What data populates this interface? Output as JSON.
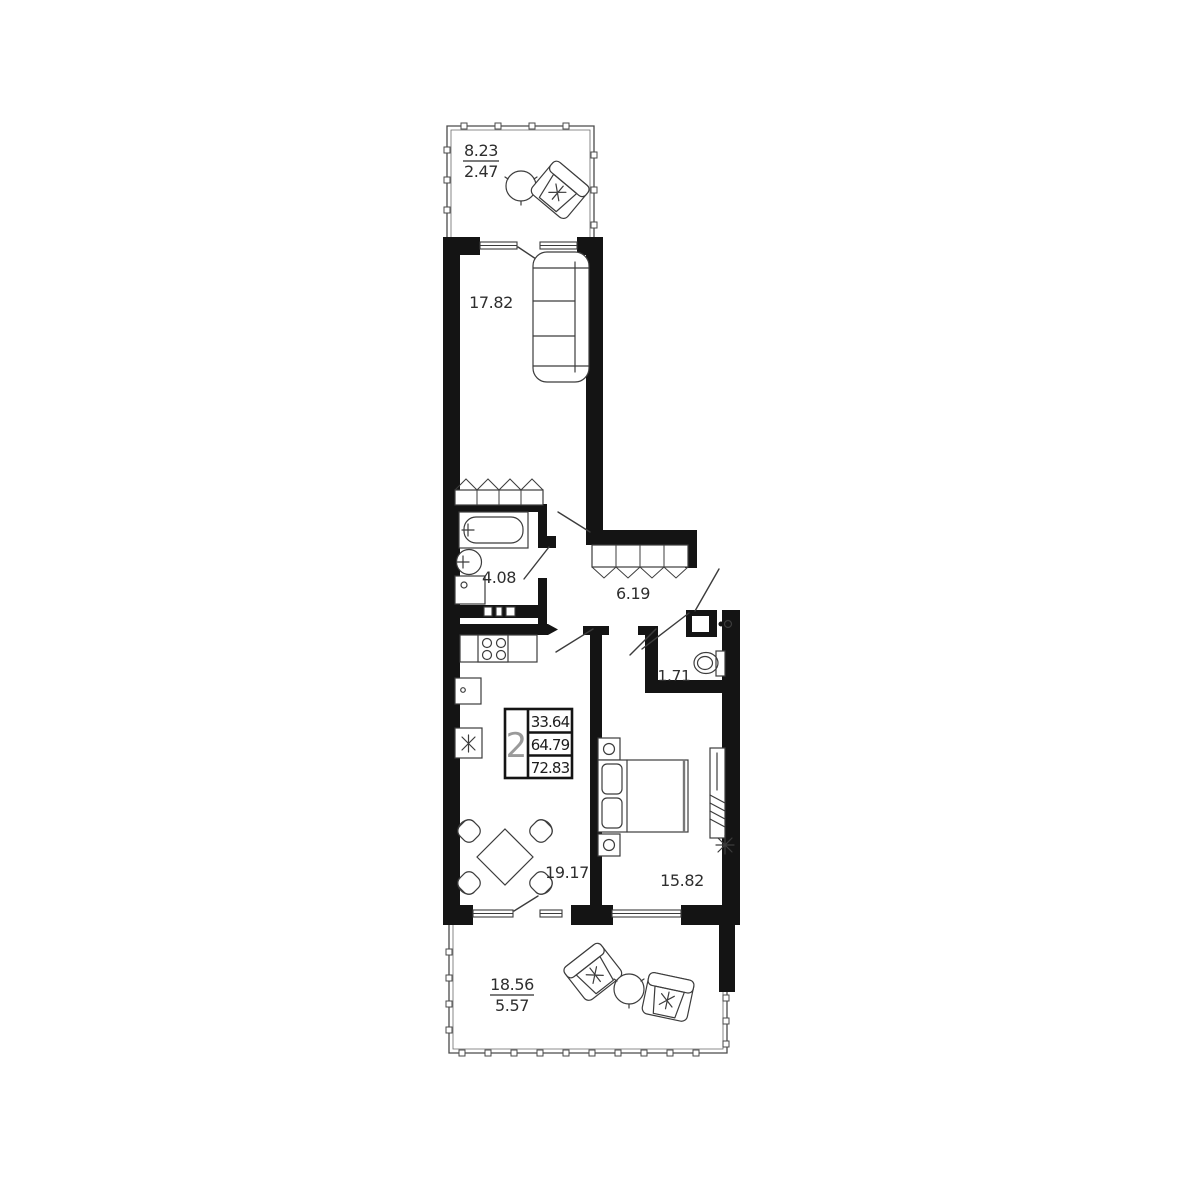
{
  "document": {
    "type": "apartment floor plan",
    "colors": {
      "wall": "#141414",
      "line": "#3c3c3c",
      "text": "#2e2e2e",
      "background": "#ffffff"
    }
  },
  "rooms": {
    "terrace_top": {
      "area": "8.23",
      "area_reduced": "2.47"
    },
    "living_room": {
      "area": "17.82"
    },
    "bathroom": {
      "area": "4.08"
    },
    "hallway": {
      "area": "6.19"
    },
    "wc": {
      "area": "1.71"
    },
    "kitchen_living": {
      "area": "19.17"
    },
    "bedroom": {
      "area": "15.82"
    },
    "terrace_bottom": {
      "area": "18.56",
      "area_reduced": "5.57"
    }
  },
  "info_box": {
    "room_count": "2",
    "values": [
      "33.64",
      "64.79",
      "72.83"
    ]
  }
}
